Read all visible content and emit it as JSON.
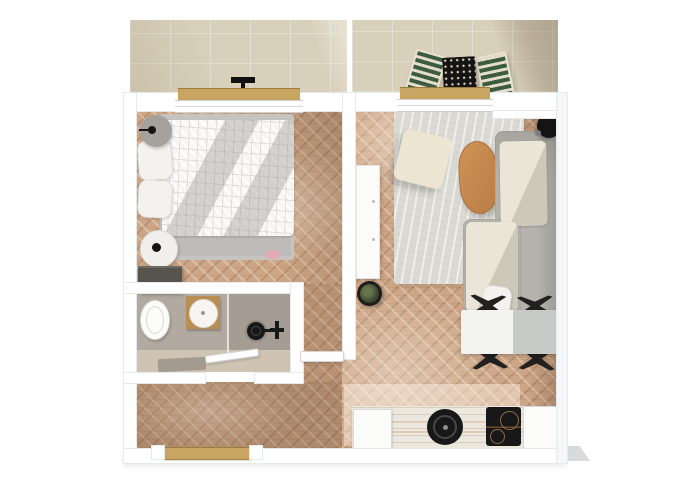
{
  "scene": {
    "title": "Top-down 3D rendered floor plan of a one-bedroom apartment with two balconies",
    "style": "photoreal top-down render, no text labels"
  },
  "colors": {
    "wall": "#ffffff",
    "wall_edge": "#e7eaeb",
    "balcony_tile": "#d9d0bb",
    "threshold_wood": "#c8a662",
    "wood_base": "#cda687",
    "bathroom_floor": "#b2a9a0",
    "shower_floor": "#a59c94",
    "bath_strip": "#cfc4b3",
    "bed_gray": "#c6c4c1",
    "duvet_white": "#f7f6f4",
    "pillow_white": "#f4f2ee",
    "nightstand_gray": "#a5a29d",
    "nightstand_white": "#f1efeb",
    "dresser_dark": "#57544e",
    "slipper_pink": "#e8a7b4",
    "vanity_wood": "#b98e55",
    "cabinet_white": "#fbfbfa",
    "rug": "#dbd9d3",
    "pouf_cream": "#ece5d2",
    "cushion_cream": "#eae5d7",
    "sofa_gray": "#b6b3ad",
    "coffee_table_wood": "#cf9357",
    "dining_white": "#f3f3f1",
    "dining_shadow": "#c8cac8",
    "chair_black": "#22211f",
    "counter_wood": "#ece8e0",
    "appliance_black": "#181818",
    "outdoor_green": "#3c5c41",
    "outdoor_frame": "#e8e2cf",
    "lamp_black": "#141414",
    "plant_green": "#3f4a33",
    "plant_pot": "#1c1c1c"
  },
  "rooms": {
    "balcony_left": {
      "label": "Bedroom balcony"
    },
    "balcony_right": {
      "label": "Living room balcony"
    },
    "bedroom": {
      "label": "Bedroom"
    },
    "bathroom": {
      "label": "Bathroom"
    },
    "shower": {
      "label": "Walk-in shower"
    },
    "hallway": {
      "label": "Entrance hallway"
    },
    "living_room": {
      "label": "Living room"
    },
    "dining_area": {
      "label": "Dining area"
    },
    "kitchen": {
      "label": "Kitchen"
    }
  },
  "furniture": {
    "bed": {
      "label": "Double bed with white duvet"
    },
    "pillow": {
      "label": "Pillow"
    },
    "nightstand_top": {
      "label": "Round nightstand with lamp"
    },
    "nightstand_bottom": {
      "label": "Round nightstand with lamp"
    },
    "dresser": {
      "label": "Low dresser"
    },
    "slippers": {
      "label": "Slippers"
    },
    "toilet": {
      "label": "Toilet"
    },
    "washbasin": {
      "label": "Round basin on wooden vanity"
    },
    "shower_head": {
      "label": "Floor drain / shower head"
    },
    "shower_mixer": {
      "label": "Shower mixer"
    },
    "bath_mat": {
      "label": "Bath mat"
    },
    "wardrobe": {
      "label": "Tall white cabinet"
    },
    "plant": {
      "label": "Potted plant"
    },
    "rug": {
      "label": "Light grey area rug"
    },
    "pouf": {
      "label": "Cream pouf"
    },
    "coffee_table": {
      "label": "Oval wooden coffee table"
    },
    "sofa": {
      "label": "Grey corner sofa with cream cushions"
    },
    "throw_pillow": {
      "label": "Throw pillow"
    },
    "floor_lamp": {
      "label": "Black floor lamp"
    },
    "dining_table": {
      "label": "White dining table"
    },
    "dining_chair": {
      "label": "Black dining chair"
    },
    "kitchen_counter": {
      "label": "Kitchen counter"
    },
    "kitchen_cabinet": {
      "label": "Kitchen cabinet"
    },
    "sink": {
      "label": "Round black sink"
    },
    "cooktop": {
      "label": "Induction cooktop"
    },
    "outdoor_chair": {
      "label": "Green slatted outdoor chair"
    },
    "outdoor_table": {
      "label": "Black perforated outdoor table"
    },
    "balcony_rack": {
      "label": "Small balcony stand"
    }
  },
  "openings": {
    "entrance_door": {
      "label": "Entrance door"
    },
    "bedroom_door": {
      "label": "Bedroom door (open)"
    },
    "bathroom_door": {
      "label": "Bathroom door (open)"
    },
    "balcony_door_left": {
      "label": "Balcony door, bedroom"
    },
    "balcony_door_right": {
      "label": "Balcony door, living room"
    }
  }
}
